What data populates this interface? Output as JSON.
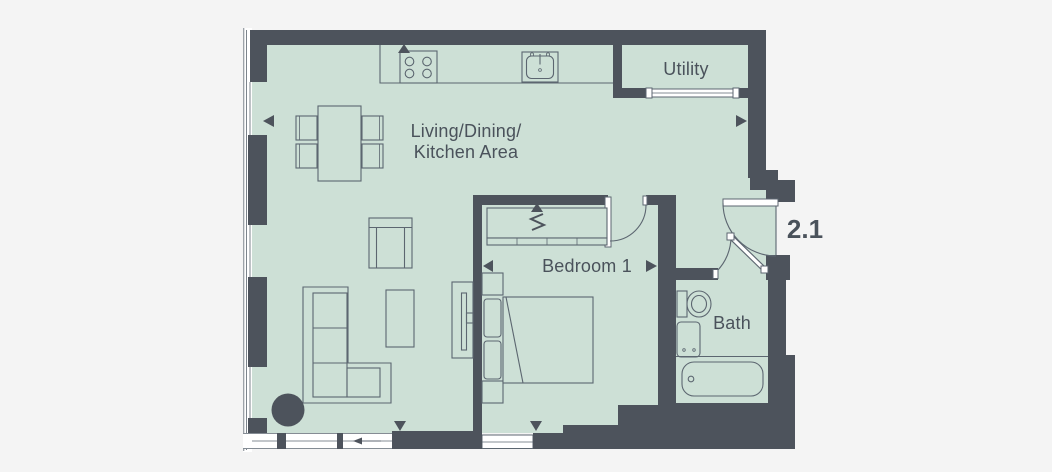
{
  "rooms": {
    "living": {
      "line1": "Living/Dining/",
      "line2": "Kitchen Area"
    },
    "bedroom": {
      "label": "Bedroom 1"
    },
    "bath": {
      "label": "Bath"
    },
    "utility": {
      "label": "Utility"
    }
  },
  "unit": {
    "number": "2.1"
  },
  "colors": {
    "floor": "#cde0d6",
    "wall": "#4d535c",
    "background": "#f4f4f4",
    "line": "#5c6670",
    "text": "#4a525b",
    "white": "#ffffff"
  }
}
